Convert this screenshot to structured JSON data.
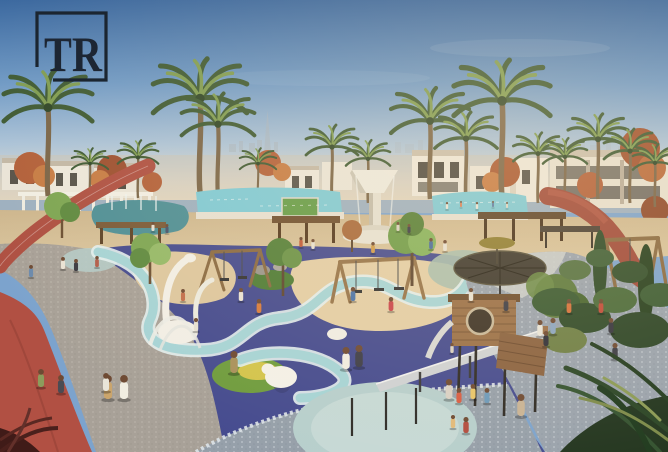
{
  "logo": {
    "text": "TR",
    "color": "#1d2633",
    "frame_color": "#1b2530"
  },
  "scene": {
    "description": "Aerial architectural rendering of a landscaped community park and playground with Dubai skyline (Burj Khalifa) on the hazy horizon",
    "landmark": "burj-khalifa",
    "palette": {
      "sky_top": "#3a67a2",
      "sky_horizon": "#e8dfcb",
      "skyline_haze": "#a9b5bf",
      "pool_water": "#7ecad6",
      "lagoon_water": "#4e8f96",
      "lawn_green": "#649c48",
      "sand": "#d8c29a",
      "play_sand": "#e3cea6",
      "playground_indigo": "#454b8f",
      "path_teal": "#a6d4d6",
      "mint_circle": "#b7cfcd",
      "track_red": "#ae5042",
      "walkway_gray": "#a8a198",
      "cobble_blue": "#9aa3ad",
      "wood": "#9a7048",
      "canopy_dark": "#3f3a30",
      "sculpture_white": "#f2efe6",
      "palm_green": "#3e5a34",
      "autumn_orange": "#b2603a"
    },
    "palms": [
      [
        48,
        196,
        1.7
      ],
      [
        90,
        200,
        0.7
      ],
      [
        138,
        198,
        0.78
      ],
      [
        200,
        192,
        1.8
      ],
      [
        218,
        197,
        1.4
      ],
      [
        258,
        200,
        0.7
      ],
      [
        332,
        199,
        1.0
      ],
      [
        368,
        203,
        0.85
      ],
      [
        430,
        199,
        1.5
      ],
      [
        466,
        201,
        1.2
      ],
      [
        502,
        197,
        1.85
      ],
      [
        538,
        203,
        0.95
      ],
      [
        565,
        201,
        0.85
      ],
      [
        598,
        199,
        1.15
      ],
      [
        630,
        203,
        1.0
      ],
      [
        655,
        207,
        0.85
      ]
    ],
    "people": [
      [
        447,
        209,
        7,
        "#e9e4d8"
      ],
      [
        461,
        207,
        6,
        "#d8825c"
      ],
      [
        477,
        209,
        7,
        "#e9e4d8"
      ],
      [
        493,
        207,
        6,
        "#5d7ca4"
      ],
      [
        507,
        208,
        6,
        "#ded6c6"
      ],
      [
        398,
        231,
        9,
        "#d9d1c1"
      ],
      [
        409,
        233,
        9,
        "#3b3b45"
      ],
      [
        301,
        247,
        10,
        "#c05a3a"
      ],
      [
        313,
        249,
        10,
        "#e7e1d3"
      ],
      [
        431,
        249,
        11,
        "#4a6c9c"
      ],
      [
        445,
        251,
        11,
        "#e7e1d3"
      ],
      [
        373,
        253,
        11,
        "#d29c4a"
      ],
      [
        63,
        269,
        12,
        "#e9e3d5"
      ],
      [
        76,
        271,
        12,
        "#3a3a42"
      ],
      [
        97,
        267,
        11,
        "#b25c4a"
      ],
      [
        31,
        277,
        12,
        "#6c8aac"
      ],
      [
        153,
        231,
        9,
        "#e5dfd1"
      ],
      [
        167,
        233,
        9,
        "#475169"
      ],
      [
        259,
        313,
        14,
        "#d87c3c"
      ],
      [
        241,
        301,
        13,
        "#e9e3d5"
      ],
      [
        353,
        301,
        14,
        "#4b73a9"
      ],
      [
        391,
        311,
        14,
        "#c9454b"
      ],
      [
        471,
        301,
        13,
        "#e7e1d3"
      ],
      [
        506,
        311,
        14,
        "#3d3d47"
      ],
      [
        546,
        346,
        15,
        "#2f2f39"
      ],
      [
        569,
        313,
        14,
        "#d5713b"
      ],
      [
        601,
        313,
        14,
        "#c14b39"
      ],
      [
        611,
        333,
        15,
        "#35353f"
      ],
      [
        615,
        359,
        16,
        "#3b3b45"
      ],
      [
        196,
        331,
        13,
        "#e7e1d3"
      ],
      [
        183,
        301,
        12,
        "#c16c4a"
      ],
      [
        540,
        336,
        16,
        "#e9e5d9"
      ],
      [
        553,
        334,
        16,
        "#8ba5c1"
      ],
      [
        108,
        399,
        24,
        "#cba56c"
      ],
      [
        124,
        399,
        24,
        "#f1ede1"
      ],
      [
        41,
        387,
        18,
        "#8c9c5c"
      ],
      [
        106,
        391,
        18,
        "#e9e5d9"
      ],
      [
        61,
        393,
        18,
        "#4b4b53"
      ],
      [
        234,
        373,
        22,
        "#a9915b"
      ],
      [
        346,
        369,
        22,
        "#f1ede1"
      ],
      [
        359,
        367,
        22,
        "#3d3d47"
      ],
      [
        449,
        399,
        20,
        "#d9d1c5"
      ],
      [
        453,
        428,
        13,
        "#e2ba7a"
      ],
      [
        521,
        416,
        22,
        "#c9b395"
      ],
      [
        459,
        403,
        15,
        "#d95c42"
      ],
      [
        473,
        399,
        15,
        "#e9c66a"
      ],
      [
        487,
        403,
        15,
        "#6c9aba"
      ],
      [
        466,
        433,
        16,
        "#b24c3e"
      ],
      [
        452,
        353,
        10,
        "#d9d1c1"
      ]
    ]
  }
}
